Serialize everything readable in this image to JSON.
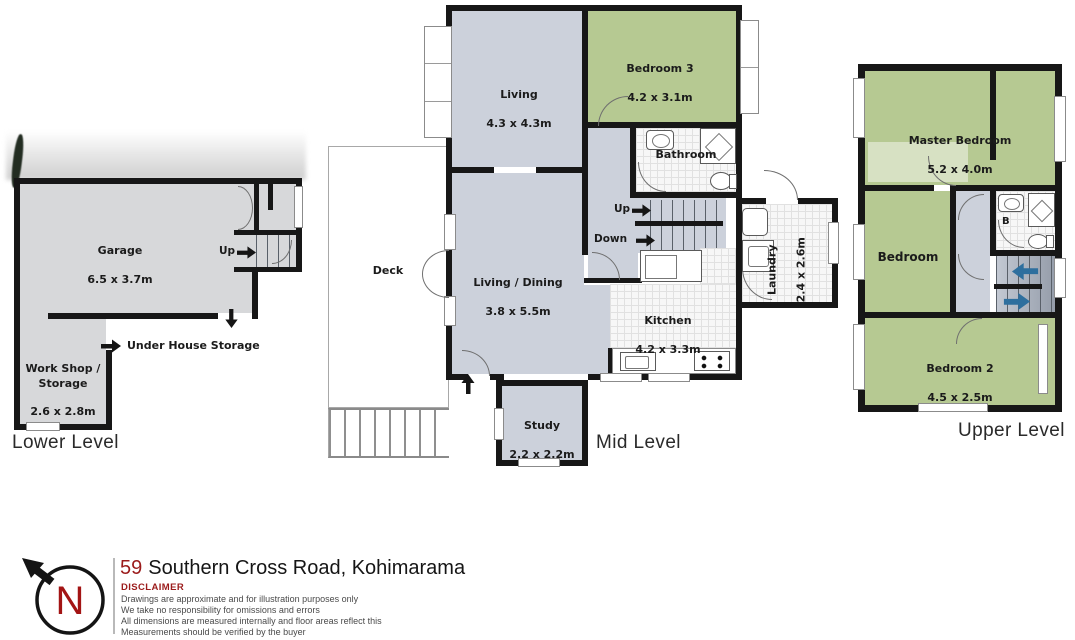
{
  "levels": {
    "lower": {
      "title": "Lower Level",
      "garage_name": "Garage",
      "garage_dims": "6.5 x 3.7m",
      "workshop_name": "Work Shop /\nStorage",
      "workshop_dims": "2.6 x 2.8m",
      "under_house_storage": "Under House Storage",
      "up_label": "Up"
    },
    "mid": {
      "title": "Mid Level",
      "living_name": "Living",
      "living_dims": "4.3 x 4.3m",
      "bedroom3_name": "Bedroom 3",
      "bedroom3_dims": "4.2 x 3.1m",
      "bathroom_name": "Bathroom",
      "living_dining_name": "Living / Dining",
      "living_dining_dims": "3.8 x 5.5m",
      "deck_name": "Deck",
      "kitchen_name": "Kitchen",
      "kitchen_dims": "4.2 x 3.3m",
      "laundry_name": "Laundry",
      "laundry_dims": "2.4 x 2.6m",
      "study_name": "Study",
      "study_dims": "2.2 x 2.2m",
      "up_label": "Up",
      "down_label": "Down"
    },
    "upper": {
      "title": "Upper Level",
      "master_name": "Master Bedroom",
      "master_dims": "5.2 x 4.0m",
      "bedroom_name": "Bedroom",
      "bedroom2_name": "Bedroom 2",
      "bedroom2_dims": "4.5 x 2.5m",
      "bath_label": "B"
    }
  },
  "footer": {
    "north": "N",
    "address_number": "59",
    "address_rest": "Southern Cross Road, Kohimarama",
    "disclaimer_title": "DISCLAIMER",
    "lines": [
      "Drawings are approximate and for illustration purposes only",
      "We take no responsibility for omissions and errors",
      "All dimensions are measured internally and floor areas reflect this",
      "Measurements should be verified by the buyer"
    ]
  },
  "colors": {
    "room_gray": "#ccd1db",
    "garage_gray": "#d7d8da",
    "bedroom_green": "#b6c992",
    "wall_black": "#171717",
    "accent_red": "#9b1b1b",
    "stair_arrow_blue": "#2e6f9e"
  }
}
